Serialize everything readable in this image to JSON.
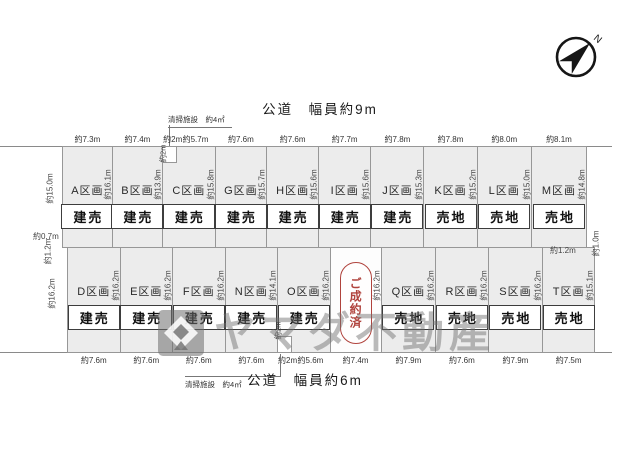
{
  "compass": {
    "label": "N"
  },
  "roads": {
    "top": "公道　幅員約9m",
    "bottom": "公道　幅員約6m"
  },
  "facility_notes": {
    "top": "清掃施設　約4㎡",
    "bottom": "清掃施設　約4㎡"
  },
  "edge_labels": {
    "left_top": "約15.0m",
    "left_step_h": "約0.7m",
    "left_step_v": "約1.2m",
    "left_bottom": "約16.2m",
    "right_step_h": "約1.2m",
    "right_step_v": "約1.0m"
  },
  "watermark": {
    "logo": "yamada-logo",
    "text": "ヤマダ不動産"
  },
  "lots": {
    "north_row": [
      {
        "name": "A区画",
        "status": "建売",
        "frontage": [
          "約7.3m"
        ],
        "side": "約16.1m",
        "width_m": 7.3
      },
      {
        "name": "B区画",
        "status": "建売",
        "frontage": [
          "約7.4m"
        ],
        "side": "約13.9m",
        "width_m": 7.4
      },
      {
        "name": "C区画",
        "status": "建売",
        "frontage": [
          "約2m",
          "約5.7m"
        ],
        "side": "約15.8m",
        "width_m": 7.7,
        "notch": "top-left",
        "notch_depth": "約2m"
      },
      {
        "name": "G区画",
        "status": "建売",
        "frontage": [
          "約7.6m"
        ],
        "side": "約15.7m",
        "width_m": 7.6
      },
      {
        "name": "H区画",
        "status": "建売",
        "frontage": [
          "約7.6m"
        ],
        "side": "約15.6m",
        "width_m": 7.6
      },
      {
        "name": "I区画",
        "status": "建売",
        "frontage": [
          "約7.7m"
        ],
        "side": "約15.6m",
        "width_m": 7.7
      },
      {
        "name": "J区画",
        "status": "建売",
        "frontage": [
          "約7.8m"
        ],
        "side": "約15.3m",
        "width_m": 7.8
      },
      {
        "name": "K区画",
        "status": "売地",
        "frontage": [
          "約7.8m"
        ],
        "side": "約15.2m",
        "width_m": 7.8
      },
      {
        "name": "L区画",
        "status": "売地",
        "frontage": [
          "約8.0m"
        ],
        "side": "約15.0m",
        "width_m": 8.0
      },
      {
        "name": "M区画",
        "status": "売地",
        "frontage": [
          "約8.1m"
        ],
        "side": "約14.8m",
        "width_m": 8.1
      }
    ],
    "south_row": [
      {
        "name": "D区画",
        "status": "建売",
        "frontage": [
          "約7.6m"
        ],
        "side": "約16.2m",
        "width_m": 7.6
      },
      {
        "name": "E区画",
        "status": "建売",
        "frontage": [
          "約7.6m"
        ],
        "side": "約16.2m",
        "width_m": 7.6
      },
      {
        "name": "F区画",
        "status": "建売",
        "frontage": [
          "約7.6m"
        ],
        "side": "約16.2m",
        "width_m": 7.6
      },
      {
        "name": "N区画",
        "status": "建売",
        "frontage": [
          "約7.6m"
        ],
        "side": "約14.1m",
        "width_m": 7.6
      },
      {
        "name": "O区画",
        "status": "建売",
        "frontage": [
          "約2m",
          "約5.6m"
        ],
        "side": "約16.2m",
        "width_m": 7.6,
        "notch": "bottom-left",
        "notch_depth": "約2m"
      },
      {
        "name": "",
        "status": "",
        "sold": true,
        "sold_label": "ご成約済",
        "frontage": [
          "約7.4m"
        ],
        "side": "約16.2m",
        "width_m": 7.4
      },
      {
        "name": "Q区画",
        "status": "売地",
        "frontage": [
          "約7.9m"
        ],
        "side": "約16.2m",
        "width_m": 7.9
      },
      {
        "name": "R区画",
        "status": "売地",
        "frontage": [
          "約7.6m"
        ],
        "side": "約16.2m",
        "width_m": 7.6
      },
      {
        "name": "S区画",
        "status": "売地",
        "frontage": [
          "約7.9m"
        ],
        "side": "約16.2m",
        "width_m": 7.9
      },
      {
        "name": "T区画",
        "status": "売地",
        "frontage": [
          "約7.5m"
        ],
        "side": "約15.1m",
        "width_m": 7.5
      }
    ]
  }
}
